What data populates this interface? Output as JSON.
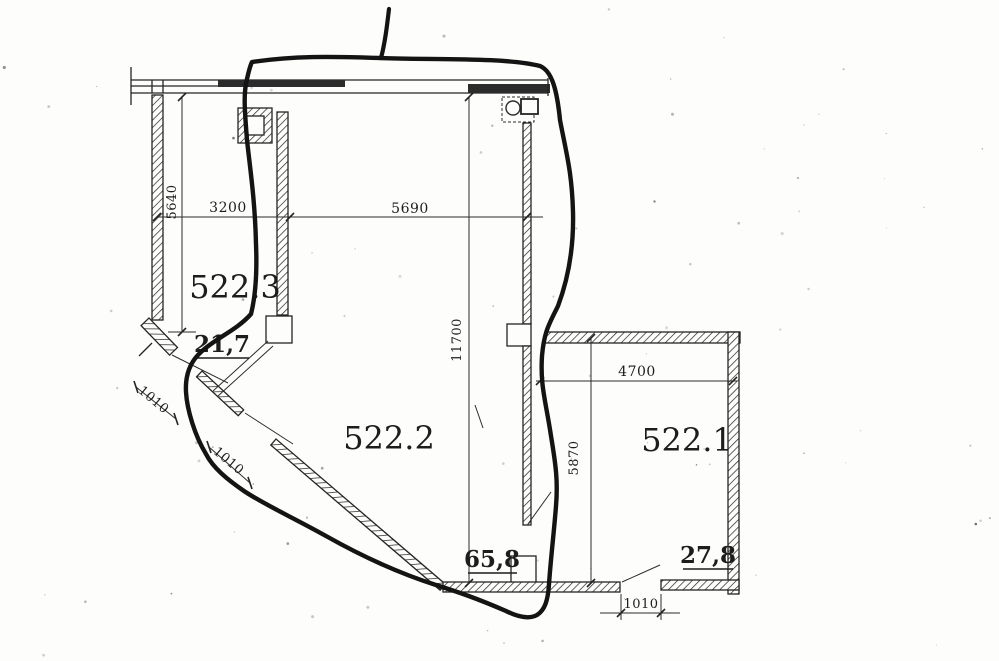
{
  "drawing": {
    "kind": "scanned floor plan with freehand marker annotation",
    "rooms": [
      {
        "number": "522.3",
        "area": "21,7"
      },
      {
        "number": "522.2",
        "area": "65,8"
      },
      {
        "number": "522.1",
        "area": "27,8"
      }
    ],
    "dimensions": {
      "v5640": "5640",
      "h3200": "3200",
      "h5690": "5690",
      "v11700": "11700",
      "h4700": "4700",
      "v5870": "5870",
      "d1010_upper": "1010",
      "d1010_lower": "1010",
      "h1010_bottom": "1010"
    },
    "colors": {
      "paper": "#fdfdfb",
      "ink": "#242424",
      "marker": "#141414"
    }
  }
}
